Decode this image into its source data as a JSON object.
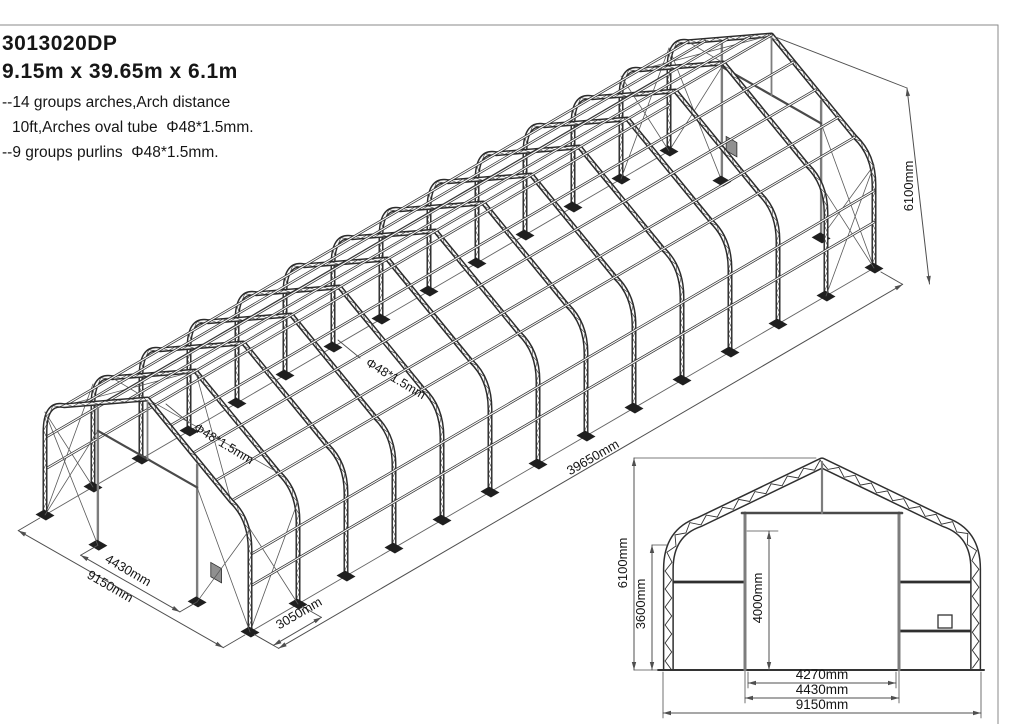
{
  "header": {
    "model": "3013020DP",
    "size": "9.15m x 39.65m x 6.1m",
    "note_arches_1": "--14 groups arches,Arch distance",
    "note_arches_2": "10ft,Arches oval tube  Φ48*1.5mm.",
    "note_purlins": "--9 groups purlins  Φ48*1.5mm."
  },
  "structure": {
    "arch_count": 14,
    "purlin_count": 9
  },
  "iso_labels": {
    "width": "9150mm",
    "door_width": "4430mm",
    "bay": "3050mm",
    "length": "39650mm",
    "height": "6100mm",
    "tube_a": "Φ48*1.5mm",
    "tube_b": "Φ48*1.5mm"
  },
  "cross_section_labels": {
    "height": "6100mm",
    "eave": "3600mm",
    "door_height": "4000mm",
    "door_clear_width": "4270mm",
    "door_width": "4430mm",
    "width": "9150mm"
  },
  "colors": {
    "structure": "#2b2b2b",
    "structure_inner": "#f8f8f8",
    "thin": "#3f3f3f",
    "brace": "#5a5a5a",
    "dim": "#4f4f4f",
    "text": "#141414",
    "door_post": "#7d7d7d",
    "panel": "#909090",
    "plate": "#1f1f1f",
    "border": "#8a8a8a",
    "background": "#ffffff"
  }
}
